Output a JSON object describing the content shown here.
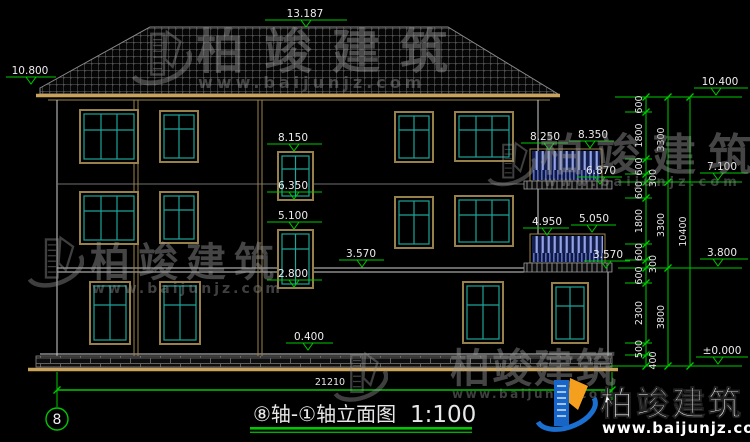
{
  "drawing": {
    "title": "⑧轴-①轴立面图",
    "scale": "1:100",
    "axis_bubble_left": "8"
  },
  "watermark": {
    "brand": "柏竣建筑",
    "url": "www.baijunjz.com"
  },
  "footer_logo": {
    "brand": "柏竣建筑",
    "url": "www.baijunjz.com"
  },
  "elevations": {
    "ridge": "13.187",
    "left_eave": "10.800",
    "right_eave": "10.400",
    "right_7100": "7.100",
    "right_3800": "3.800",
    "right_zero": "±0.000",
    "stair_w1_head": "8.150",
    "stair_w1_sill": "6.350",
    "stair_w2_head": "5.100",
    "stair_w2_sill": "2.800",
    "floor2_left": "3.570",
    "balc3_rail_left": "8.250",
    "balc3_rail_right": "8.350",
    "balc3_floor": "6.870",
    "balc2_rail_left": "4.950",
    "balc2_rail_right": "5.050",
    "balc2_floor": "3.570",
    "plinth": "0.400"
  },
  "dimensions": {
    "total_width": "21210",
    "right_chain_total": "10400",
    "right_chain_floor": [
      "3300",
      "3300",
      "3800"
    ],
    "right_chain_small": [
      "600",
      "1800",
      "600",
      "300",
      "600",
      "1800",
      "600",
      "300",
      "600",
      "2300",
      "500",
      "400"
    ]
  },
  "colors": {
    "dimension_green": "#00c800",
    "frame_tan": "#97804a",
    "glazing_teal": "#1fa39a",
    "railing_blue": "#93a2e6",
    "ground_tan": "#c9a35c",
    "logo_blue": "#1a6fd0",
    "logo_orange": "#f59f1f"
  }
}
